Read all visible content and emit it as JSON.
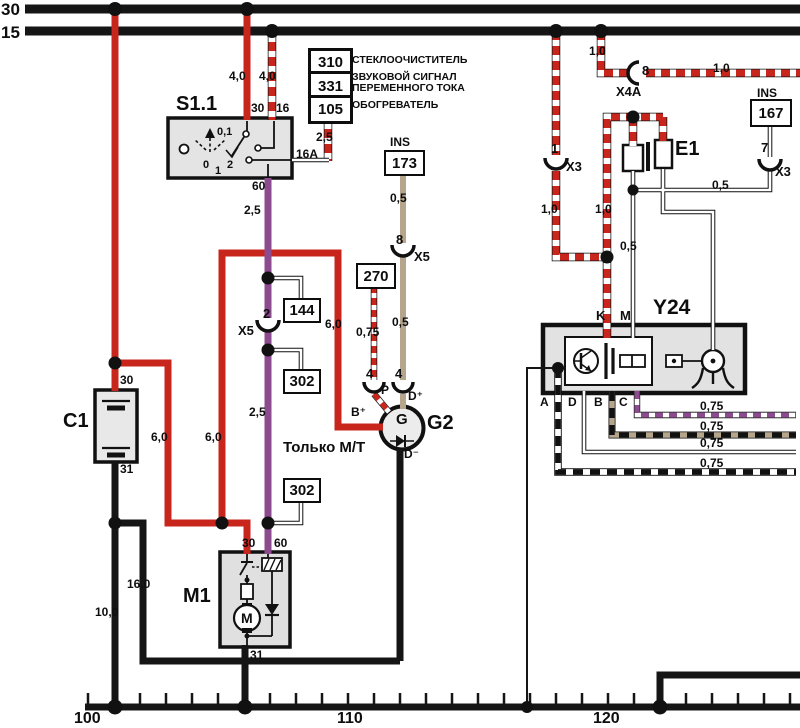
{
  "colors": {
    "red": "#c8251d",
    "purple": "#8d4b8f",
    "tan": "#b4a58c",
    "black": "#151515",
    "component_fill": "#e4e4e4"
  },
  "buses": {
    "b30": "30",
    "b15": "15"
  },
  "legend": {
    "entries": [
      {
        "code": "310",
        "line1": "СТЕКЛООЧИСТИТЕЛЬ",
        "line2": ""
      },
      {
        "code": "331",
        "line1": "ЗВУКОВОЙ СИГНАЛ",
        "line2": "ПЕРЕМЕННОГО ТОКА"
      },
      {
        "code": "105",
        "line1": "ОБОГРЕВАТЕЛЬ",
        "line2": ""
      }
    ]
  },
  "components": {
    "s11": {
      "name": "S1.1",
      "pin30": "30",
      "pin16": "16",
      "pin16a": "16A",
      "pin60": "60",
      "inner_value": "0,1",
      "pos0": "0",
      "pos1": "1",
      "pos2": "2"
    },
    "c1": {
      "name": "C1",
      "pin30": "30",
      "pin31": "31"
    },
    "m1": {
      "name": "M1",
      "pin30": "30",
      "pin60": "60",
      "pin31": "31",
      "motor": "M"
    },
    "g2": {
      "name": "G2",
      "gen": "G",
      "pin_b": "B⁺",
      "pin_p": "P",
      "pin_d": "D⁺",
      "pin_dm": "D⁻",
      "conn4a": "4",
      "conn4b": "4"
    },
    "e1": {
      "name": "E1"
    },
    "y24": {
      "name": "Y24",
      "pin_k": "K",
      "pin_m": "M",
      "pin_a": "A",
      "pin_b": "B",
      "pin_c": "C",
      "pin_d": "D"
    }
  },
  "ref_boxes": {
    "ins_top": "INS",
    "b173": "173",
    "b270": "270",
    "b144": "144",
    "b302a": "302",
    "b302b": "302",
    "ins_right": "INS",
    "b167": "167"
  },
  "connectors": {
    "x5_2_pin": "2",
    "x5_2": "X5",
    "x5_8_pin": "8",
    "x5_8": "X5",
    "x4a_pin": "8",
    "x4a": "X4A",
    "x3_1_pin": "1",
    "x3_1": "X3",
    "x3_7_pin": "7",
    "x3_7": "X3"
  },
  "gauges": {
    "w40a": "4,0",
    "w40b": "4,0",
    "w25a": "2,5",
    "w25b": "2,5",
    "w25c": "2,5",
    "w05a": "0,5",
    "w05b": "0,5",
    "w05c": "0,5",
    "w05d": "0,5",
    "w075a": "0,75",
    "w10a": "1,0",
    "w10b": "1,0",
    "w10c": "1,0",
    "w10d": "1,0",
    "w60a": "6,0",
    "w60b": "6,0",
    "w60c": "6,0",
    "w160": "16,0",
    "w100": "10,0",
    "y075_a": "0,75",
    "y075_b": "0,75",
    "y075_c": "0,75",
    "y075_d": "0,75"
  },
  "note_mt": "Только М/Т",
  "ruler": {
    "m100": "100",
    "m110": "110",
    "m120": "120"
  }
}
